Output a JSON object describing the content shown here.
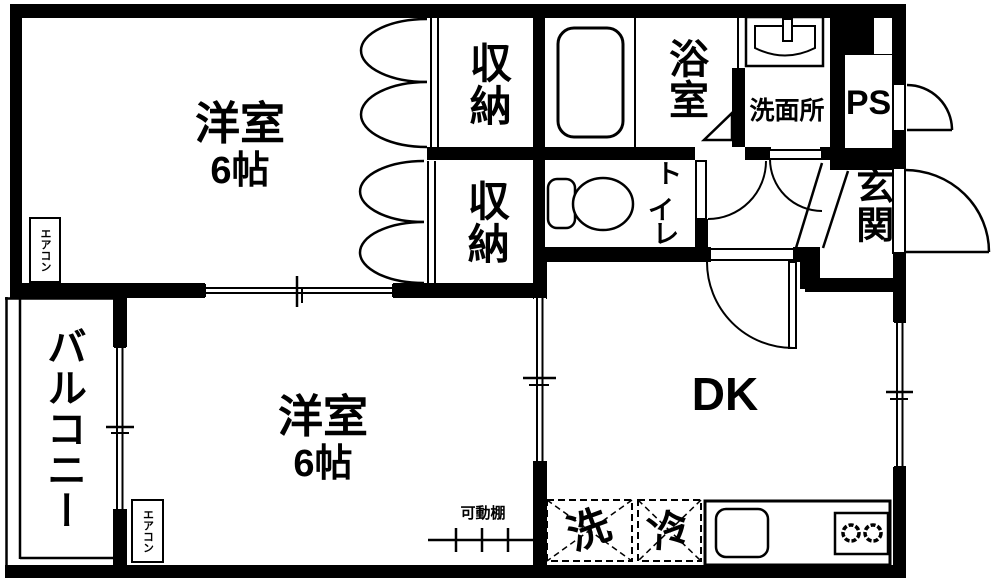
{
  "colors": {
    "wall": "#000000",
    "floor": "#ffffff",
    "line": "#000000"
  },
  "rooms": {
    "bedroom1": {
      "name": "洋室",
      "size": "6帖"
    },
    "bedroom2": {
      "name": "洋室",
      "size": "6帖"
    },
    "dining_kitchen": {
      "label": "DK"
    },
    "bathroom": {
      "label": "浴室"
    },
    "washroom": {
      "label": "洗面所"
    },
    "toilet": {
      "label": "トイレ",
      "chars": [
        "ト",
        "イ",
        "レ"
      ]
    },
    "entrance": {
      "label": "玄関"
    },
    "pipe_space": {
      "label": "PS"
    },
    "balcony": {
      "label": "バルコニー"
    },
    "closet_upper": {
      "label": "収納"
    },
    "closet_lower": {
      "label": "収納"
    }
  },
  "labels": {
    "aircon_bedroom1": "エアコン",
    "aircon_bedroom2": "エアコン",
    "movable_shelf": "可動棚",
    "washer_space": "洗",
    "fridge_space": "冷"
  }
}
